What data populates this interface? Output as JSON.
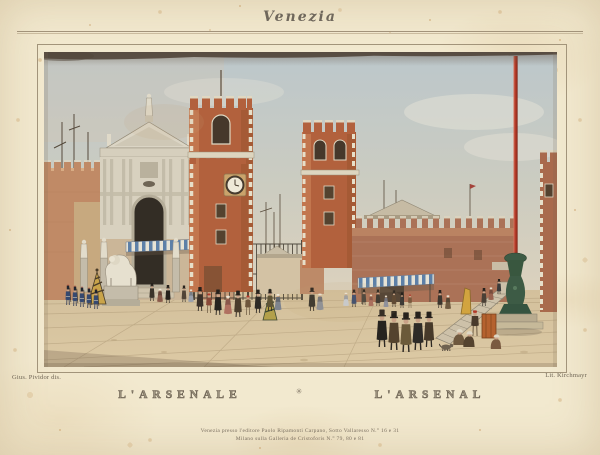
{
  "artwork": {
    "series_title": "Venezia",
    "captions": {
      "italian": "L'ARSENALE",
      "french": "L'ARSENAL",
      "divider": "✳"
    },
    "credits": {
      "artist": "Gius. Pividor dis.",
      "lithographer": "Lit. Kirchmayr"
    },
    "imprint": {
      "line1": "Venezia presso l'editore Paolo Ripamonti Carpano, Sotto Vallaresso N.° 16 e 31",
      "line2": "Milano sulla Galleria de Cristoforis N.° 79, 80 e 81"
    },
    "palette": {
      "paper": "#f2e9cf",
      "sky": "#c3cdd0",
      "brick": "#b2613d",
      "stone": "#d8d1bf",
      "awning_blue": "#5d80a8",
      "flagpole_red": "#b23a28",
      "bronze_green": "#3d5b45",
      "foxing": "#c89a5e"
    }
  }
}
